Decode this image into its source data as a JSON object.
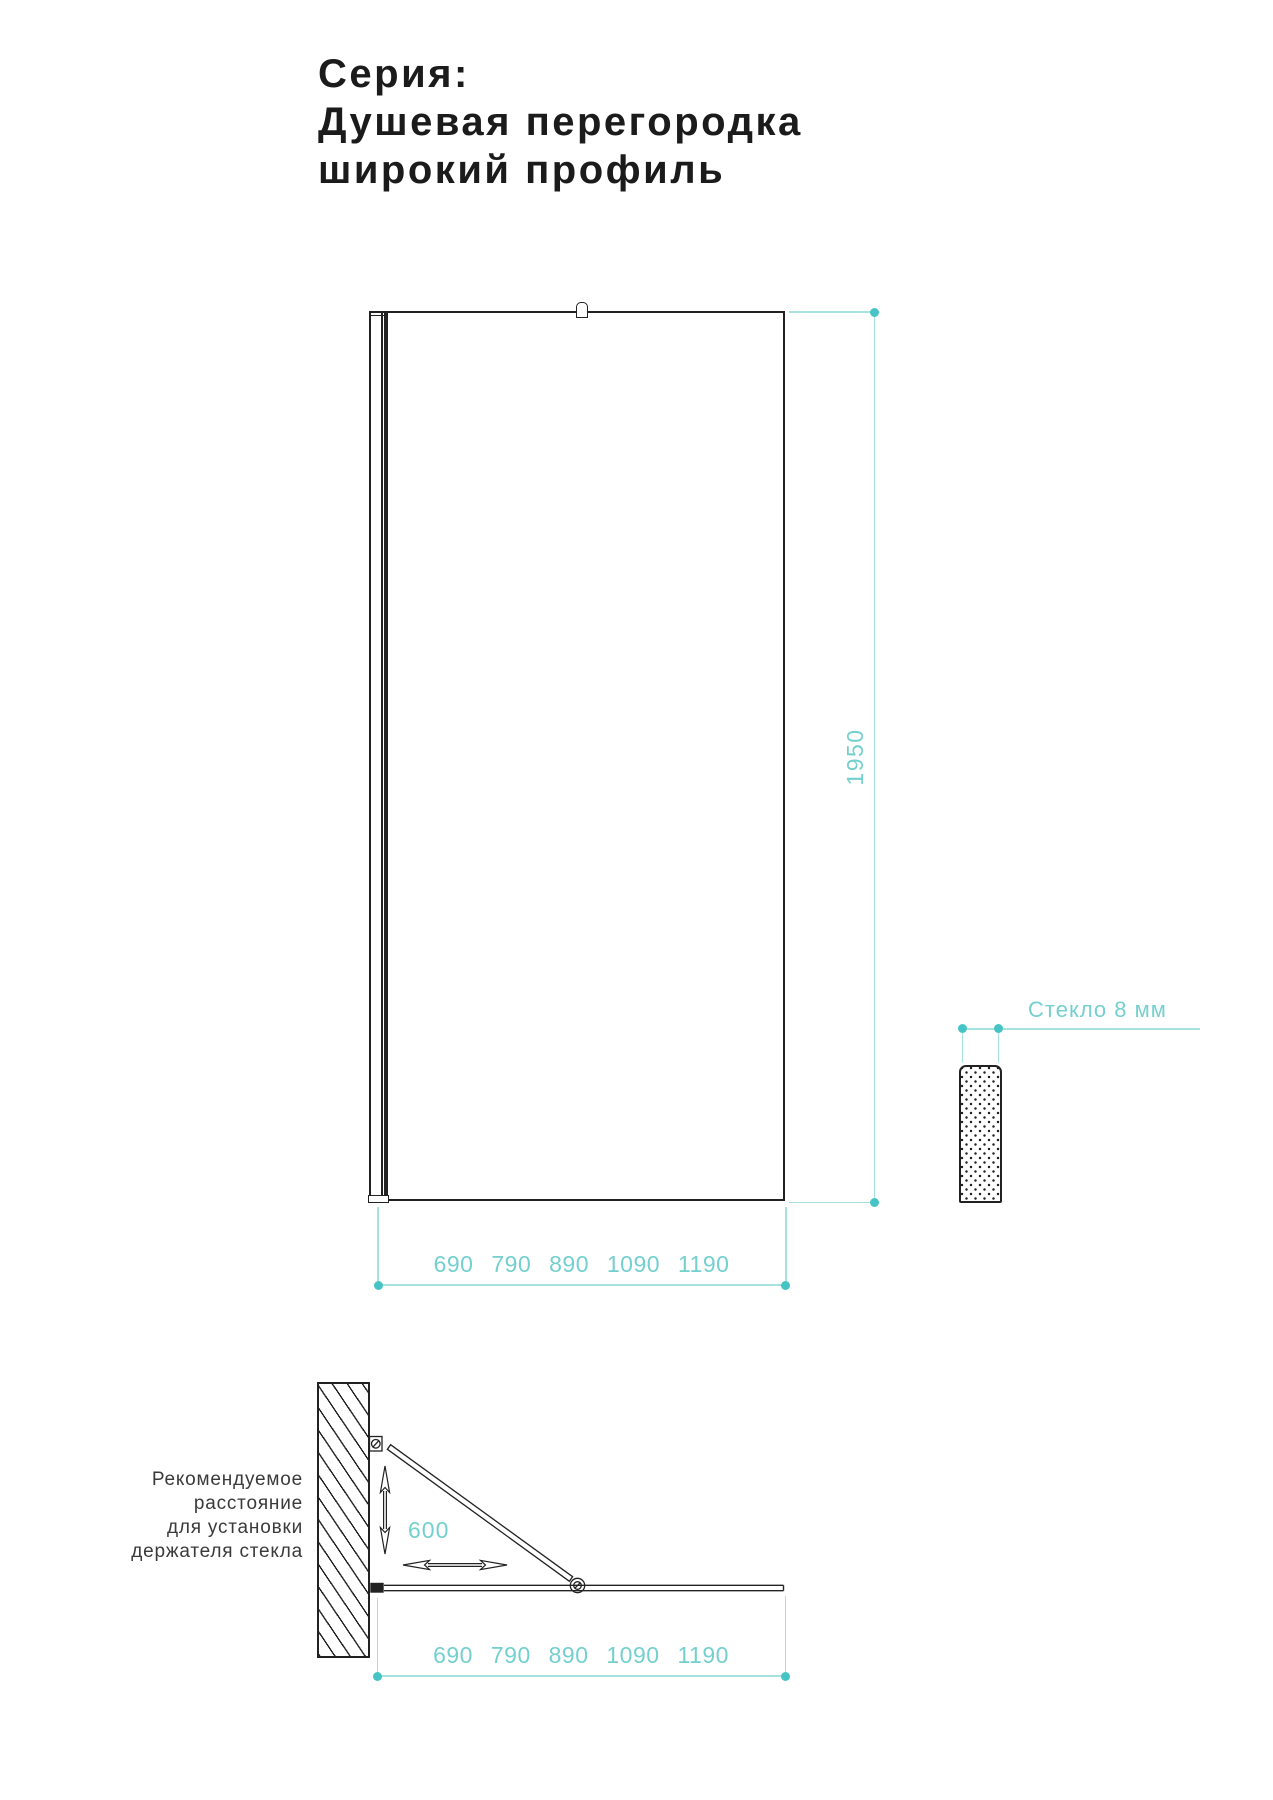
{
  "title": "Серия:\nДушевая перегородка\nширокий профиль",
  "front_view": {
    "height_label": "1950",
    "widths_label": "690 790 890 1090 1190"
  },
  "glass_detail": {
    "label": "Стекло 8 мм"
  },
  "plan_view": {
    "caption": "Рекомендуемое\nрасстояние\nдля установки\nдержателя стекла",
    "holder_distance_label": "600",
    "widths_label": "690 790 890 1090 1190"
  },
  "colors": {
    "accent_teal_line": "#a5e2e0",
    "accent_teal_dot": "#46c4c5",
    "accent_teal_text": "#74d0ce",
    "drawing_black": "#222222"
  }
}
